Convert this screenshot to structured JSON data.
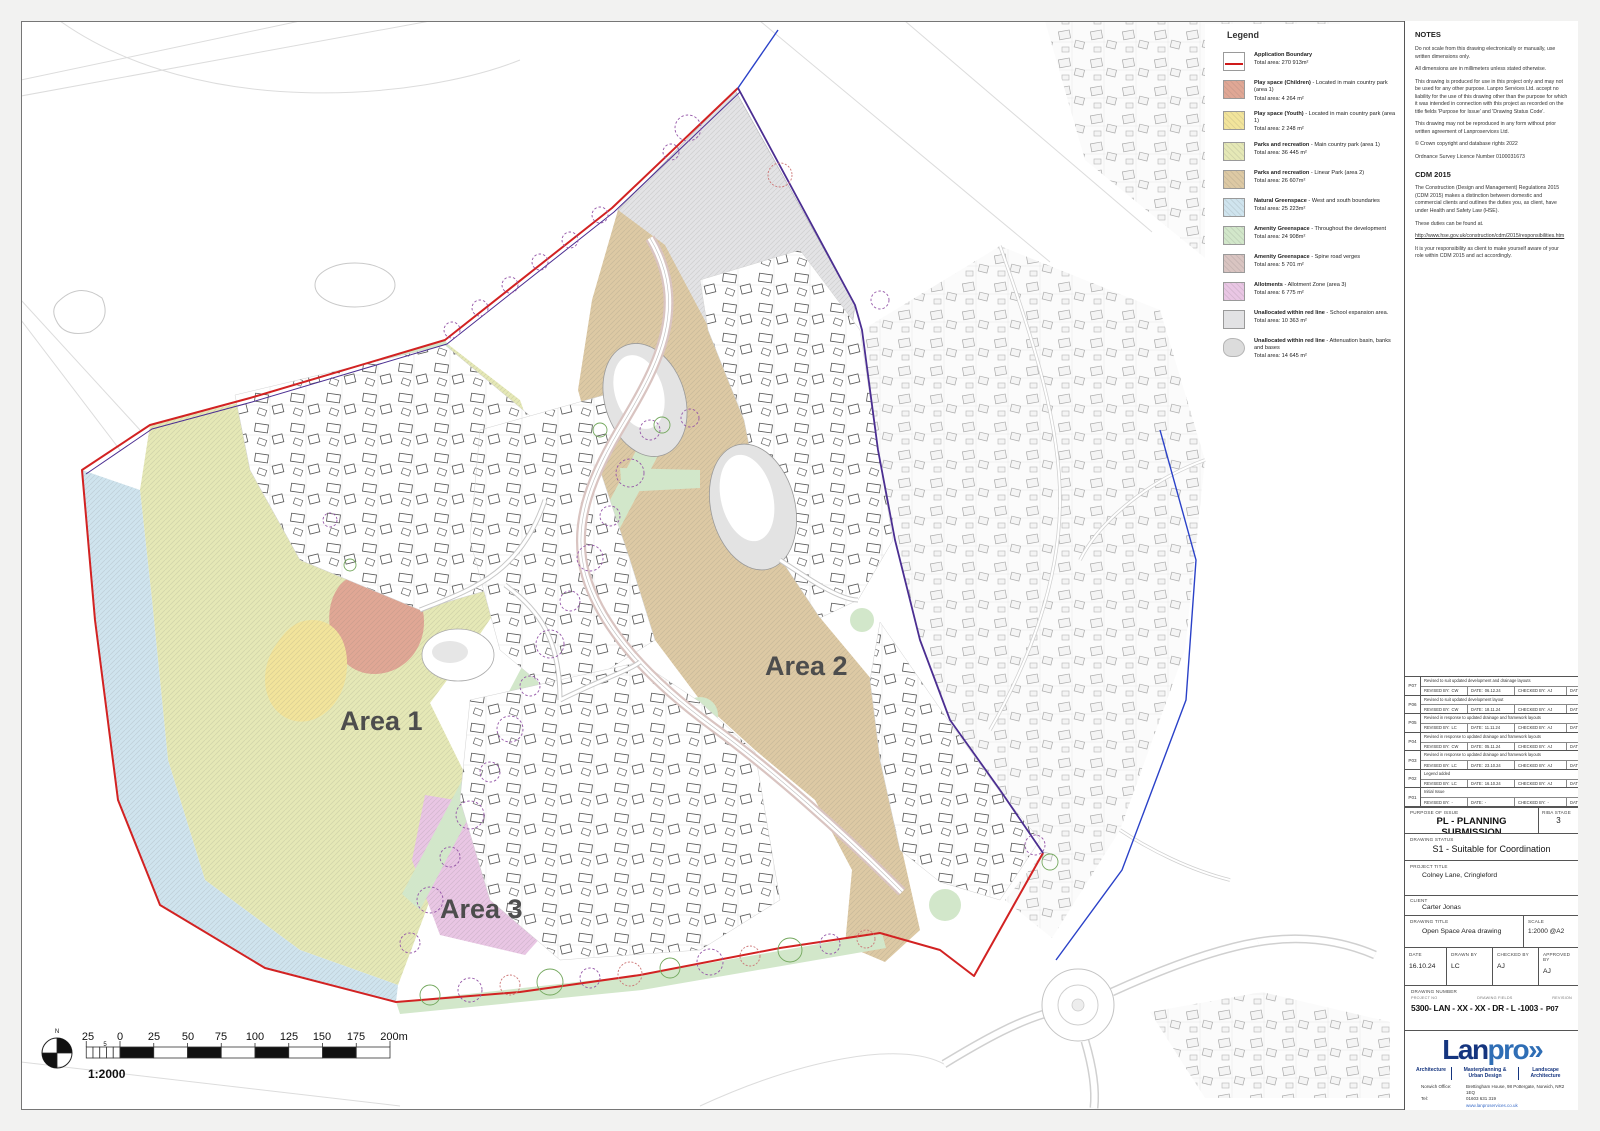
{
  "map": {
    "area_labels": [
      "Area 1",
      "Area 2",
      "Area 3"
    ],
    "scale_bar": {
      "labels": [
        "25",
        "0",
        "25",
        "50",
        "75",
        "100",
        "125",
        "150",
        "175",
        "200m"
      ],
      "minor": "5",
      "ratio": "1:2000",
      "north": "N"
    }
  },
  "legend": {
    "title": "Legend",
    "items": [
      {
        "type": "boundary",
        "color": "#ffffff",
        "name": "Application Boundary",
        "desc": "",
        "area": "Total area: 270 913m²"
      },
      {
        "type": "hatch",
        "color": "#e0a795",
        "name": "Play space (Children)",
        "desc": " - Located in main country park (area 1)",
        "area": "Total area: 4 264 m²"
      },
      {
        "type": "hatch",
        "color": "#f2e49b",
        "name": "Play space (Youth)",
        "desc": " - Located in main country park (area 1)",
        "area": "Total area: 2 248 m²"
      },
      {
        "type": "hatch",
        "color": "#e5e8b6",
        "name": "Parks and recreation",
        "desc": " - Main country park (area 1)",
        "area": "Total area: 36 445 m²"
      },
      {
        "type": "hatch",
        "color": "#ddc9a4",
        "name": "Parks and recreation",
        "desc": " - Linear Park (area 2)",
        "area": "Total area: 26 607m²"
      },
      {
        "type": "hatch",
        "color": "#cfe4ee",
        "name": "Natural Greenspace",
        "desc": " - West and south boundaries",
        "area": "Total area: 25 223m²"
      },
      {
        "type": "hatch",
        "color": "#d2e7ca",
        "name": "Amenity Greenspace",
        "desc": " - Throughout the development",
        "area": "Total area: 24 908m²"
      },
      {
        "type": "hatch",
        "color": "#d9c4c1",
        "name": "Amenity Greenspace",
        "desc": " - Spine road verges",
        "area": "Total area: 5 701 m²"
      },
      {
        "type": "hatch",
        "color": "#e9c6e4",
        "name": "Allotments",
        "desc": " - Allotment Zone (area 3)",
        "area": "Total area: 6 775 m²"
      },
      {
        "type": "plain",
        "color": "#e2e2e4",
        "name": "Unallocated within red line",
        "desc": " - School expansion area.",
        "area": "Total area: 10 363 m²"
      },
      {
        "type": "blob",
        "color": "#dcdcdc",
        "name": "Unallocated within red line",
        "desc": " - Attenuation basin, banks and bases",
        "area": "Total area: 14 645 m²"
      }
    ]
  },
  "panel": {
    "notes": {
      "title": "NOTES",
      "paragraphs": [
        "Do not scale from this drawing electronically or manually, use written dimensions only.",
        "All dimensions are in millimeters unless stated otherwise.",
        "This drawing is produced for use in this project only and may not be used for any other purpose. Lanpro Services Ltd. accept no liability for the use of this drawing other than the purpose for which it was intended in connection with this project as recorded on the title fields 'Purpose for Issue' and 'Drawing Status Code'.",
        "This drawing may not be reproduced in any form without prior written agreement of Lanproservices Ltd.",
        "© Crown copyright and database rights 2022",
        "Ordnance Survey Licence Number 0100031673"
      ]
    },
    "cdm": {
      "title": "CDM 2015",
      "paragraphs": [
        "The Construction (Design and Management) Regulations 2015 (CDM 2015) makes a distinction between domestic and commercial clients and outlines the duties you, as client, have under Health and Safety Law (HSE).",
        "These duties can be found at."
      ],
      "link": "http://www.hse.gov.uk/construction/cdm/2015/responsibilities.htm",
      "after": "It is your responsibility as client to make yourself aware of your role within CDM 2015 and act accordingly."
    },
    "revisions": {
      "labels": {
        "revised": "REVISED BY:",
        "date": "DATE:",
        "checked": "CHECKED BY:"
      },
      "rows": [
        {
          "code": "P07",
          "desc": "Revised to suit updated development and drainage layouts",
          "revised_by": "CW",
          "date": "06.12.24",
          "checked_by": "AJ",
          "check_date": "06.12.24"
        },
        {
          "code": "P06",
          "desc": "Revised to suit updated development layout",
          "revised_by": "CW",
          "date": "18.11.24",
          "checked_by": "AJ",
          "check_date": "18.11.24"
        },
        {
          "code": "P05",
          "desc": "Revised in response to updated drainage and framework layouts",
          "revised_by": "LC",
          "date": "11.11.24",
          "checked_by": "AJ",
          "check_date": "11.11.24"
        },
        {
          "code": "P04",
          "desc": "Revised in response to updated drainage and framework layouts",
          "revised_by": "CW",
          "date": "05.11.24",
          "checked_by": "AJ",
          "check_date": "05.11.24"
        },
        {
          "code": "P03",
          "desc": "Revised in response to updated drainage and framework layouts",
          "revised_by": "LC",
          "date": "23.10.24",
          "checked_by": "AJ",
          "check_date": "23.10.24"
        },
        {
          "code": "P02",
          "desc": "Legend added",
          "revised_by": "LC",
          "date": "16.10.24",
          "checked_by": "AJ",
          "check_date": "16.10.24"
        },
        {
          "code": "P01",
          "desc": "Initial Issue",
          "revised_by": "-",
          "date": "-",
          "checked_by": "-",
          "check_date": "-"
        }
      ]
    },
    "purpose": {
      "label": "PURPOSE OF ISSUE",
      "value": "PL - PLANNING SUBMISSION",
      "riba_label": "RIBA STAGE",
      "riba_value": "3"
    },
    "status": {
      "label": "DRAWING STATUS",
      "value": "S1 - Suitable for Coordination"
    },
    "project": {
      "label": "PROJECT TITLE",
      "value": "Colney Lane, Cringleford"
    },
    "client": {
      "label": "CLIENT",
      "value": "Carter Jonas"
    },
    "title": {
      "label": "DRAWING TITLE",
      "value": "Open Space Area drawing",
      "scale_label": "SCALE",
      "scale_value": "1:2000 @A2"
    },
    "meta": {
      "date_label": "DATE",
      "date": "16.10.24",
      "drawn_label": "DRAWN BY",
      "drawn": "LC",
      "checked_label": "CHECKED BY",
      "checked": "AJ",
      "approved_label": "APPROVED BY",
      "approved": "AJ"
    },
    "number": {
      "label": "DRAWING NUMBER",
      "project_no_label": "PROJECT NO",
      "fields_label": "DRAWING FIELDS",
      "revision_label": "REVISION",
      "value": "5300- LAN - XX - XX - DR - L -1003 -",
      "revision": "P07"
    },
    "logo": {
      "word_a": "Lan",
      "word_b": "pro",
      "chevrons": "»",
      "services": [
        "Architecture",
        "Masterplanning & Urban Design",
        "Landscape Architecture"
      ],
      "office_label": "Norwich Office:",
      "address": "Brettingham House, 98 Pottergate, Norwich, NR2 1EQ",
      "tel_label": "Tel:",
      "tel": "01603 631 319",
      "web": "www.lanproservices.co.uk"
    }
  }
}
